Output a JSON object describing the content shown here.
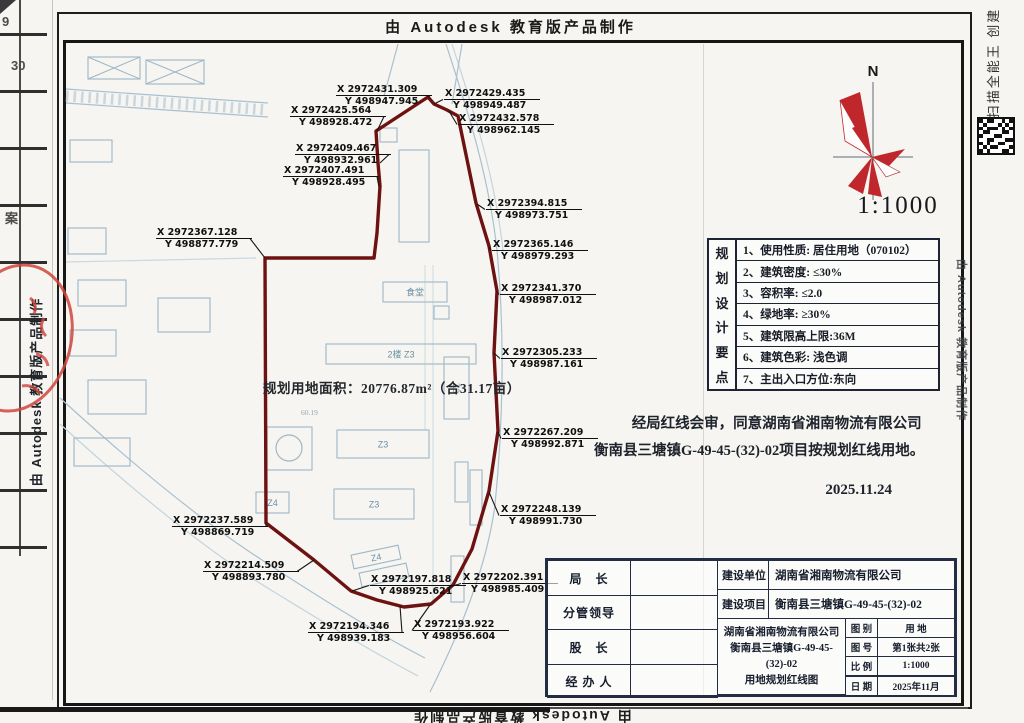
{
  "banners": {
    "top": "由 Autodesk 教育版产品制作",
    "bottom_rotated": "由 Autodesk 教育版产品制作",
    "left_vertical": "由 Autodesk 教育版产品制作",
    "right_vertical": "由 Autodesk 教育版产品制作",
    "scanner_watermark": "扫描全能王 创建"
  },
  "adjacent_page": {
    "fragments": [
      {
        "text": "9",
        "x": 2,
        "y": 14
      },
      {
        "text": "30",
        "x": 11,
        "y": 58
      },
      {
        "text": "案",
        "x": 5,
        "y": 208
      }
    ]
  },
  "compass": {
    "north_label": "N",
    "scale": "1:1000"
  },
  "plan": {
    "area_text": "规划用地面积：20776.87m²（合31.17亩）",
    "elevation_note": "60.19",
    "boundary_color": "#6d1111",
    "boundary": [
      [
        265,
        258
      ],
      [
        374,
        258
      ],
      [
        377,
        233
      ],
      [
        380,
        186
      ],
      [
        378,
        163
      ],
      [
        376,
        131
      ],
      [
        428,
        97
      ],
      [
        434,
        104
      ],
      [
        447,
        110
      ],
      [
        458,
        116
      ],
      [
        476,
        203
      ],
      [
        489,
        246
      ],
      [
        497,
        291
      ],
      [
        494,
        353
      ],
      [
        498,
        431
      ],
      [
        489,
        491
      ],
      [
        472,
        549
      ],
      [
        453,
        585
      ],
      [
        431,
        604
      ],
      [
        404,
        607
      ],
      [
        377,
        600
      ],
      [
        351,
        591
      ],
      [
        314,
        560
      ],
      [
        266,
        523
      ]
    ],
    "buildings": [
      {
        "x": 383,
        "y": 282,
        "w": 64,
        "h": 20,
        "label": "食堂"
      },
      {
        "x": 434,
        "y": 306,
        "w": 15,
        "h": 13,
        "label": ""
      },
      {
        "x": 326,
        "y": 344,
        "w": 150,
        "h": 20,
        "label": "2楼  Z3"
      },
      {
        "x": 444,
        "y": 357,
        "w": 25,
        "h": 62,
        "label": "Z3",
        "vertical": true
      },
      {
        "x": 337,
        "y": 430,
        "w": 92,
        "h": 28,
        "label": "Z3"
      },
      {
        "x": 334,
        "y": 489,
        "w": 80,
        "h": 30,
        "label": "Z3"
      },
      {
        "x": 256,
        "y": 492,
        "w": 33,
        "h": 21,
        "label": "Z4"
      },
      {
        "x": 267,
        "y": 427,
        "w": 45,
        "h": 43,
        "label": ""
      },
      {
        "x": 399,
        "y": 150,
        "w": 30,
        "h": 92,
        "label": ""
      },
      {
        "x": 380,
        "y": 128,
        "w": 17,
        "h": 14,
        "label": ""
      },
      {
        "x": 455,
        "y": 462,
        "w": 13,
        "h": 40,
        "label": ""
      },
      {
        "x": 451,
        "y": 556,
        "w": 13,
        "h": 46,
        "label": ""
      },
      {
        "x": 470,
        "y": 470,
        "w": 12,
        "h": 55,
        "label": ""
      },
      {
        "x": 352,
        "y": 550,
        "w": 48,
        "h": 14,
        "rot": -12,
        "label": "Z4"
      },
      {
        "x": 360,
        "y": 568,
        "w": 48,
        "h": 14,
        "rot": -12,
        "label": ""
      },
      {
        "x": 70,
        "y": 140,
        "w": 42,
        "h": 22,
        "label": ""
      },
      {
        "x": 68,
        "y": 228,
        "w": 38,
        "h": 26,
        "label": ""
      },
      {
        "x": 78,
        "y": 280,
        "w": 48,
        "h": 26,
        "label": ""
      },
      {
        "x": 70,
        "y": 330,
        "w": 46,
        "h": 26,
        "label": ""
      },
      {
        "x": 88,
        "y": 380,
        "w": 58,
        "h": 34,
        "label": ""
      },
      {
        "x": 74,
        "y": 438,
        "w": 56,
        "h": 28,
        "label": ""
      },
      {
        "x": 158,
        "y": 298,
        "w": 52,
        "h": 34,
        "label": ""
      },
      {
        "x": 88,
        "y": 57,
        "w": 52,
        "h": 22,
        "cross": true,
        "label": ""
      },
      {
        "x": 146,
        "y": 60,
        "w": 58,
        "h": 24,
        "cross": true,
        "label": ""
      }
    ],
    "coordinate_labels": [
      {
        "x": "2972431.309",
        "y": "498947.945",
        "tx": 336,
        "ty": 84,
        "vx": 428,
        "vy": 97,
        "side": "right"
      },
      {
        "x": "2972429.435",
        "y": "498949.487",
        "tx": 444,
        "ty": 88,
        "vx": 434,
        "vy": 104,
        "side": "left"
      },
      {
        "x": "2972432.578",
        "y": "498962.145",
        "tx": 458,
        "ty": 113,
        "vx": 449,
        "vy": 111,
        "side": "left"
      },
      {
        "x": "2972425.564",
        "y": "498928.472",
        "tx": 290,
        "ty": 105,
        "vx": 377,
        "vy": 131,
        "side": "right"
      },
      {
        "x": "2972409.467",
        "y": "498932.961",
        "tx": 295,
        "ty": 143,
        "vx": 380,
        "vy": 163,
        "side": "right"
      },
      {
        "x": "2972407.491",
        "y": "498928.495",
        "tx": 283,
        "ty": 165,
        "vx": 379,
        "vy": 187,
        "side": "right"
      },
      {
        "x": "2972367.128",
        "y": "498877.779",
        "tx": 156,
        "ty": 227,
        "vx": 265,
        "vy": 258,
        "side": "right"
      },
      {
        "x": "2972394.815",
        "y": "498973.751",
        "tx": 486,
        "ty": 198,
        "vx": 477,
        "vy": 204,
        "side": "left"
      },
      {
        "x": "2972365.146",
        "y": "498979.293",
        "tx": 492,
        "ty": 239,
        "vx": 489,
        "vy": 247,
        "side": "left"
      },
      {
        "x": "2972341.370",
        "y": "498987.012",
        "tx": 500,
        "ty": 283,
        "vx": 497,
        "vy": 291,
        "side": "left"
      },
      {
        "x": "2972305.233",
        "y": "498987.161",
        "tx": 501,
        "ty": 347,
        "vx": 494,
        "vy": 353,
        "side": "left"
      },
      {
        "x": "2972267.209",
        "y": "498992.871",
        "tx": 502,
        "ty": 427,
        "vx": 498,
        "vy": 432,
        "side": "left"
      },
      {
        "x": "2972248.139",
        "y": "498991.730",
        "tx": 500,
        "ty": 504,
        "vx": 489,
        "vy": 492,
        "side": "left"
      },
      {
        "x": "2972237.589",
        "y": "498869.719",
        "tx": 172,
        "ty": 515,
        "vx": 266,
        "vy": 523,
        "side": "right"
      },
      {
        "x": "2972214.509",
        "y": "498893.780",
        "tx": 203,
        "ty": 560,
        "vx": 314,
        "vy": 560,
        "side": "right"
      },
      {
        "x": "2972197.818",
        "y": "498925.621",
        "tx": 370,
        "ty": 574,
        "vx": 352,
        "vy": 591,
        "side": "left"
      },
      {
        "x": "2972202.391",
        "y": "498985.409",
        "tx": 462,
        "ty": 572,
        "vx": 449,
        "vy": 587,
        "side": "left"
      },
      {
        "x": "2972194.346",
        "y": "498939.183",
        "tx": 308,
        "ty": 621,
        "vx": 400,
        "vy": 606,
        "side": "right"
      },
      {
        "x": "2972193.922",
        "y": "498956.604",
        "tx": 413,
        "ty": 619,
        "vx": 430,
        "vy": 605,
        "side": "left"
      }
    ]
  },
  "requirements": {
    "side_title": "规划设计要点",
    "items": [
      "1、使用性质: 居住用地（070102）",
      "2、建筑密度: ≤30%",
      "3、容积率: ≤2.0",
      "4、绿地率: ≥30%",
      "5、建筑限高上限:36M",
      "6、建筑色彩: 浅色调",
      "7、主出入口方位:东向"
    ]
  },
  "approval": {
    "line1": "经局红线会审，同意湖南省湘南物流有限公司",
    "line2": "衡南县三塘镇G-49-45-(32)-02项目按规划红线用地。",
    "date": "2025.11.24"
  },
  "title_block": {
    "officials": [
      "局　长",
      "分管领导",
      "股　长",
      "经 办 人"
    ],
    "unit_label": "建设单位",
    "unit_value": "湖南省湘南物流有限公司",
    "project_label": "建设项目",
    "project_value": "衡南县三塘镇G-49-45-(32)-02",
    "center_lines": [
      "湖南省湘南物流有限公司",
      "衡南县三塘镇G-49-45-(32)-02",
      "用地规划红线图"
    ],
    "meta": [
      {
        "label": "图 别",
        "value": "用  地"
      },
      {
        "label": "图 号",
        "value": "第1张共2张"
      },
      {
        "label": "比 例",
        "value": "1:1000"
      },
      {
        "label": "日 期",
        "value": "2025年11月"
      }
    ]
  }
}
